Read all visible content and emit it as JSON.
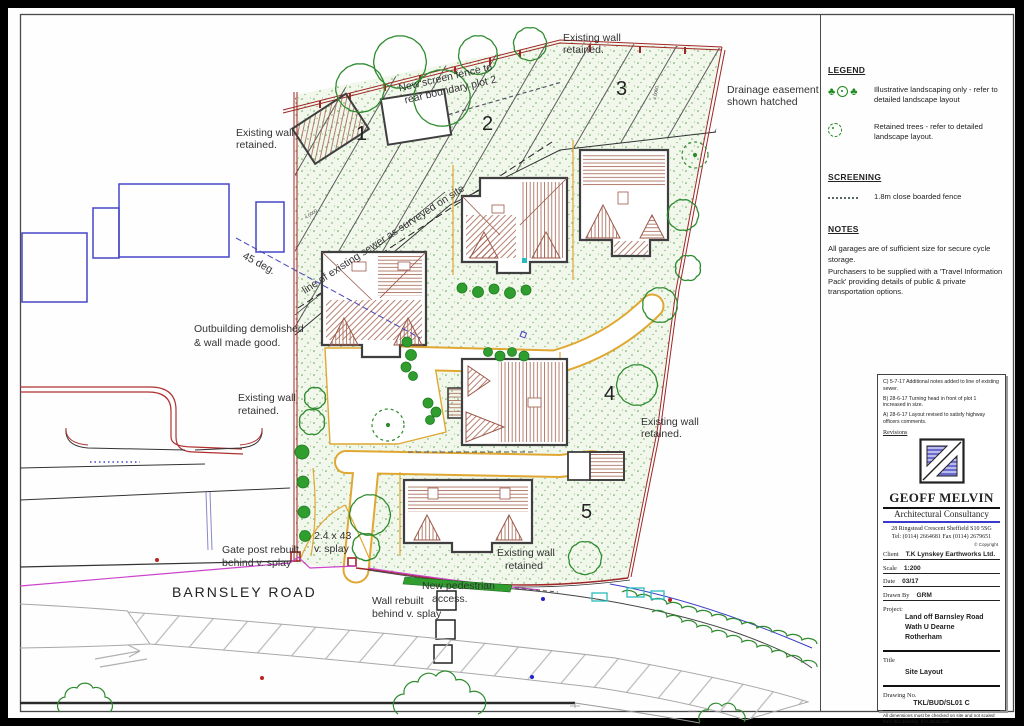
{
  "legend": {
    "heading": "LEGEND",
    "items": [
      {
        "icon": "illustrative-landscaping-icon",
        "text": "Illustrative landscaping only - refer to detailed landscape layout"
      },
      {
        "icon": "retained-tree-icon",
        "text": "Retained trees - refer to detailed landscape layout."
      }
    ],
    "screening_heading": "SCREENING",
    "screening_item": "1.8m close boarded fence",
    "notes_heading": "NOTES",
    "notes": [
      "All garages are of sufficient size for secure cycle storage.",
      "Purchasers to be supplied with a 'Travel Information Pack' providing details of public & private transportation options."
    ]
  },
  "title_block": {
    "revisions": [
      "C) 5-7-17 Additional notes added to line of existing sewer.",
      "B) 28-6-17 Turning head in front of plot 1 increased in size.",
      "A) 28-6-17 Layout revised to satisfy highway officers comments."
    ],
    "revisions_label": "Revisions",
    "firm_name": "GEOFF MELVIN",
    "firm_subtitle": "Architectural Consultancy",
    "address": "28 Ringstead Crescent Sheffield S10 5SG",
    "phone": "Tel: (0114) 2664681 Fax (0114) 2679651",
    "copyright": "© Copyright",
    "fields": {
      "client_label": "Client",
      "client": "T.K Lynskey Earthworks Ltd.",
      "scale_label": "Scale",
      "scale": "1:200",
      "date_label": "Date",
      "date": "03/17",
      "drawn_by_label": "Drawn By",
      "drawn_by": "GRM",
      "project_label": "Project:",
      "project_lines": [
        "Land off Barnsley Road",
        "Wath U Dearne",
        "Rotherham"
      ],
      "title_label": "Title",
      "title": "Site Layout",
      "drawing_no_label": "Drawing No.",
      "drawing_no": "TKL/BUD/SL01 C"
    },
    "disclaimer": "All dimensions must be checked on site and not scaled from this drawing. If in doubt ask."
  },
  "plan": {
    "road_name": "BARNSLEY ROAD",
    "plot_numbers": [
      "1",
      "2",
      "3",
      "4",
      "5"
    ],
    "dims": {
      "d1": "4.0000",
      "d2": "4.0000"
    },
    "labels": {
      "wall_top_1": "Existing wall",
      "wall_top_2": "retained.",
      "drainage_1": "Drainage easement",
      "drainage_2": "shown hatched",
      "fence_1": "New screen fence to",
      "fence_2": "rear boundary plot 2",
      "wall_left_1": "Existing wall",
      "wall_left_2": "retained.",
      "sewer": "line of existing sewer as surveyed on site",
      "deg45": "45 deg.",
      "outbuilding_1": "Outbuilding demolished",
      "outbuilding_2": "& wall made good.",
      "wall_midleft_1": "Existing wall",
      "wall_midleft_2": "retained.",
      "wall_plot4_1": "Existing wall",
      "wall_plot4_2": "retained.",
      "splay_1": "2.4 x 43",
      "splay_2": "v. splay",
      "gatepost_1": "Gate post rebuilt",
      "gatepost_2": "behind v. splay",
      "wall_rebuilt_1": "Wall rebuilt",
      "wall_rebuilt_2": "behind v. splay",
      "ped_1": "New pedestrian",
      "ped_2": "access.",
      "wall_plot5_1": "Existing wall",
      "wall_plot5_2": "retained"
    }
  },
  "colors": {
    "wall_red": "#a02525",
    "landscape_green": "#2e8b2e",
    "boundary_yellow": "#e0a832",
    "existing_blue": "#4646c8",
    "utility_magenta": "#cc44cc",
    "marker_cyan": "#2abcbc",
    "roof_brown": "#a2604e",
    "logo_blue": "#6b6bd0"
  }
}
